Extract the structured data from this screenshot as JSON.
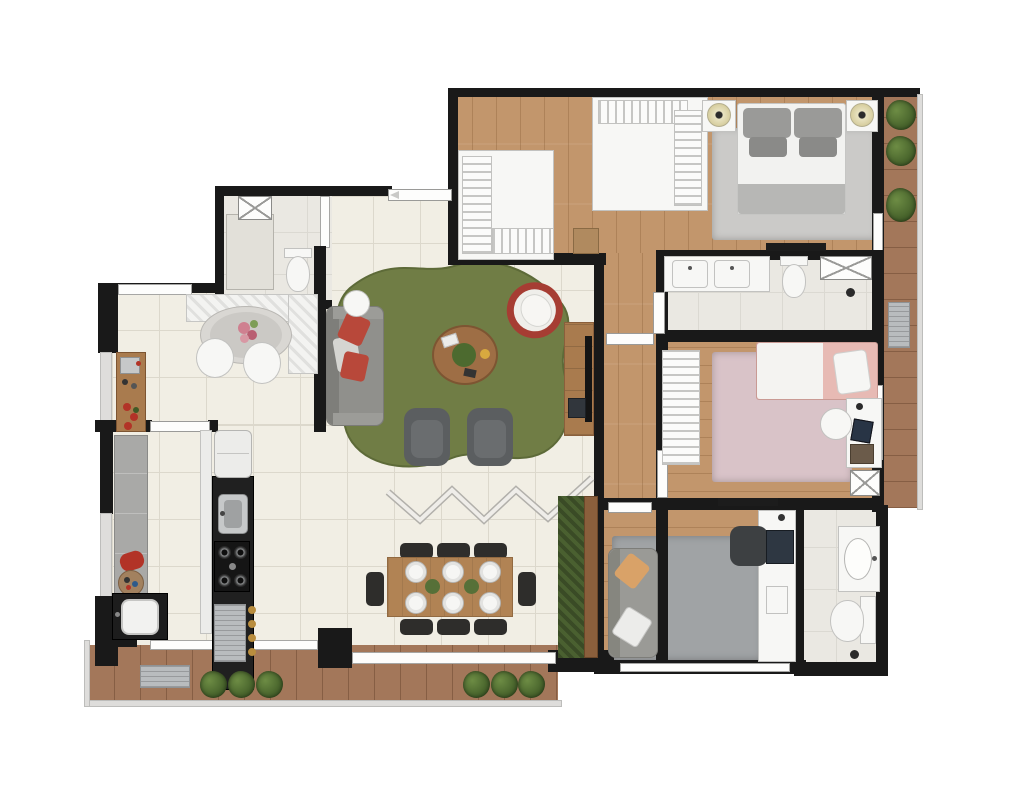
{
  "meta": {
    "type": "architectural-floor-plan",
    "view": "top-down 3D rendered apartment plan",
    "visible_text": "none — the screenshot contains no text labels",
    "canvas": {
      "width": 1024,
      "height": 807
    }
  },
  "palette": {
    "wall": "#191919",
    "tile_floor": "#f1eee4",
    "marble_floor": "#eae8e2",
    "wood_floor": "#c2966c",
    "deck_floor": "#a3775a",
    "rug_green": "#707d45",
    "rug_master_gray": "#cbcac8",
    "rug_pink": "#d9c3c8",
    "rug_office_gray": "#a0a3a5",
    "sofa_gray": "#90908c",
    "pillow_red": "#b8483a",
    "pillow_orange": "#d9a268",
    "armchair_dark": "#5b5e60",
    "wood_furniture": "#a97b4e",
    "dining_table_wood": "#b18354",
    "chair_black": "#2e2d2b",
    "white_furniture": "#f7f7f5",
    "steel": "#c6c8c9",
    "plant_green": "#4f7030",
    "counter_black": "#202020",
    "egg_chair_red": "#a63d33",
    "bed_pink": "#e7bab4",
    "glass_gray": "#dedddb"
  },
  "rooms": [
    {
      "id": "living-room",
      "label": "Living room",
      "floor": "tile",
      "furniture": [
        "gray sofa with two red pillows",
        "round white side table",
        "round wood coffee table with decor",
        "red hanging egg chair with white cushion",
        "two dark gray armchairs",
        "wood TV console with TV and media device",
        "large organic-shaped green rug"
      ]
    },
    {
      "id": "dining-area",
      "label": "Dining area",
      "floor": "tile",
      "furniture": [
        "rectangular wood dining table",
        "eight black chairs",
        "six white place settings",
        "two green centerpieces",
        "vertical garden planter",
        "zigzag folding glass partition"
      ]
    },
    {
      "id": "breakfast-nook",
      "label": "Breakfast nook",
      "floor": "tile",
      "furniture": [
        "oval gray table",
        "L-shaped white bench",
        "two white chairs",
        "pink flower centerpiece",
        "wood coffee sideboard with espresso set and red flowers"
      ]
    },
    {
      "id": "kitchen",
      "label": "Kitchen",
      "floor": "tile",
      "furniture": [
        "white refrigerator",
        "black counter run",
        "steel sink",
        "four-burner cooktop",
        "dish rack / oven module",
        "four bottles"
      ]
    },
    {
      "id": "laundry-area",
      "label": "Laundry / service area",
      "floor": "tile",
      "furniture": [
        "gray counter",
        "red iron",
        "decor plate",
        "utility sink on black counter"
      ]
    },
    {
      "id": "powder-room",
      "label": "Powder room",
      "floor": "marble",
      "furniture": [
        "toilet",
        "marble shower stall",
        "storage cabinet (X symbol)"
      ]
    },
    {
      "id": "hallway",
      "label": "Bedroom hallway",
      "floor": "wood",
      "furniture": [
        "suite entry door",
        "bathroom door",
        "bedroom door",
        "office door"
      ]
    },
    {
      "id": "walk-in-closet",
      "label": "Walk-in closet",
      "floor": "wood",
      "furniture": [
        "four hanging rack modules",
        "small dresser"
      ]
    },
    {
      "id": "master-bedroom",
      "label": "Master bedroom",
      "floor": "wood",
      "furniture": [
        "double bed with gray bedding",
        "two nightstands with round lamps",
        "light gray area rug",
        "wall TV panel"
      ]
    },
    {
      "id": "master-bathroom",
      "label": "Master bathroom",
      "floor": "marble",
      "furniture": [
        "double-sink vanity",
        "toilet",
        "glass shower box (X symbol)",
        "floor drain"
      ]
    },
    {
      "id": "bedroom-2",
      "label": "Bedroom 2 (pink)",
      "floor": "wood",
      "furniture": [
        "single bed with pink bedding and white pillow",
        "pink rug",
        "hanging-rack wardrobe",
        "white desk with chair, tablet and books",
        "storage cabinet (X symbol)",
        "wall TV panel"
      ]
    },
    {
      "id": "home-office",
      "label": "Bedroom 3 / home office",
      "floor": "wood",
      "furniture": [
        "gray sofa with orange and white pillows",
        "gray rug",
        "white desk strip",
        "dark office chair",
        "laptop",
        "phone dock"
      ]
    },
    {
      "id": "bathroom-2",
      "label": "Bathroom 2",
      "floor": "marble",
      "furniture": [
        "oval-sink vanity",
        "toilet",
        "shower floor drain"
      ]
    },
    {
      "id": "terrace-balcony",
      "label": "Terrace balcony",
      "floor": "deck",
      "furniture": [
        "AC condenser unit",
        "six green shrubs",
        "glass railing"
      ]
    },
    {
      "id": "side-balcony",
      "label": "Side balcony",
      "floor": "deck",
      "furniture": [
        "three green shrubs",
        "AC condenser unit",
        "glass railing"
      ]
    }
  ],
  "icons": [
    {
      "name": "plant-icon",
      "meaning": "green shrub in planter"
    },
    {
      "name": "lamp-icon",
      "meaning": "round bedside lamp"
    },
    {
      "name": "drain-icon",
      "meaning": "shower floor drain"
    },
    {
      "name": "burner-icon",
      "meaning": "cooktop burner"
    },
    {
      "name": "x-cabinet-icon",
      "meaning": "crossed-box cabinet / shower symbol"
    },
    {
      "name": "entry-arrow-icon",
      "meaning": "entrance door direction arrow"
    },
    {
      "name": "zigzag-partition-icon",
      "meaning": "accordion folding glass partition"
    },
    {
      "name": "hanger-rack-icon",
      "meaning": "closet hanging rack (striped)"
    }
  ]
}
